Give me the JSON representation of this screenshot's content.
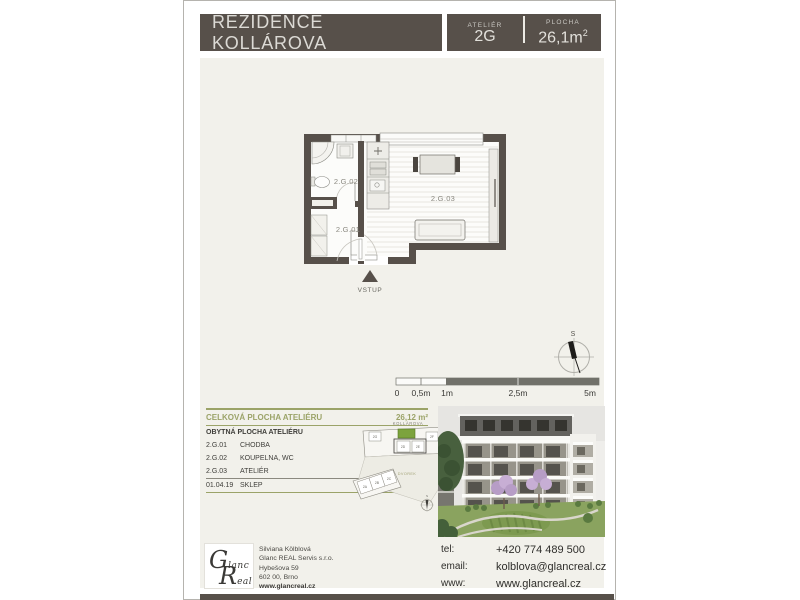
{
  "header": {
    "title": "REZIDENCE KOLLÁROVA",
    "unit_label": "ATELIÉR",
    "unit_value": "2G",
    "area_label": "PLOCHA",
    "area_value": "26,1m",
    "area_sup": "2"
  },
  "floor_plan": {
    "labels": {
      "room1": "2.G.02",
      "room2": "2.G.01",
      "room3": "2.G.03",
      "entrance": "VSTUP"
    }
  },
  "scale_bar": {
    "ticks": [
      "0",
      "0,5m",
      "1m",
      "2,5m",
      "5m"
    ]
  },
  "compass": {
    "north": "S"
  },
  "area_table": {
    "header": {
      "label": "CELKOVÁ PLOCHA ATELIÉRU",
      "value": "26,12 m²"
    },
    "rows": [
      {
        "code": "",
        "name": "OBYTNÁ PLOCHA ATELIÉRU",
        "value": "25,34 m²"
      },
      {
        "code": "2.G.01",
        "name": "CHODBA",
        "value": "3,50 m²"
      },
      {
        "code": "2.G.02",
        "name": "KOUPELNA, WC",
        "value": "3,77 m²"
      },
      {
        "code": "2.G.03",
        "name": "ATELIÉR",
        "value": "18,07 m²"
      },
      {
        "code": "01.04.19",
        "name": "SKLEP",
        "value": "2,22 m²"
      }
    ]
  },
  "site_plan": {
    "street": "KOLLÁROVA",
    "courtyard": "DVOREK",
    "north": "S",
    "units_top": [
      "2G",
      "2F",
      "2D",
      "2E"
    ],
    "units_bottom": [
      "2A",
      "2B",
      "2C"
    ]
  },
  "footer": {
    "logo": {
      "cap1": "G",
      "rest1": "lanc",
      "cap2": "R",
      "rest2": "eal"
    },
    "agent": {
      "name": "Silviana Kölblová",
      "company": "Glanc REAL Servis s.r.o.",
      "street": "Hybešova 59",
      "city": "602 00, Brno",
      "web": "www.glancreal.cz"
    },
    "contact": {
      "tel_label": "tel:",
      "tel": "+420 774 489 500",
      "email_label": "email:",
      "email": "kolblova@glancreal.cz",
      "www_label": "www:",
      "www": "www.glancreal.cz"
    }
  },
  "colors": {
    "brand_dark": "#57504a",
    "content_beige": "#f2f1eb",
    "accent_green": "#9ba368",
    "highlight_green": "#7ca33d"
  }
}
